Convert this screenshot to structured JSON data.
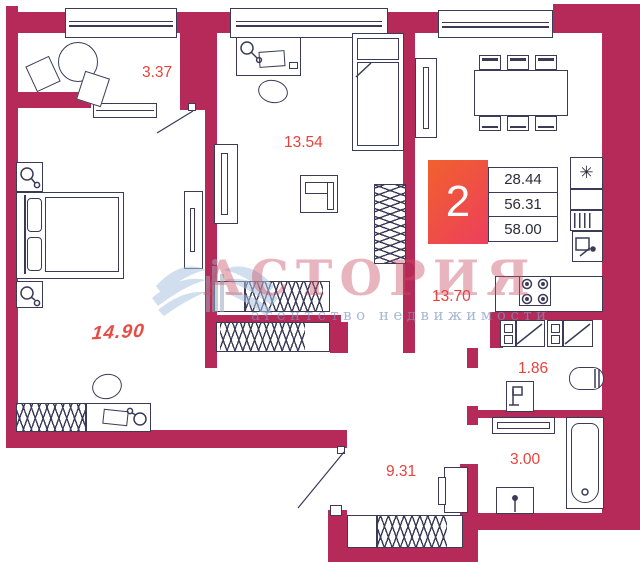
{
  "plan": {
    "badge": {
      "number": "2",
      "area_living": "28.44",
      "area_total": "56.31",
      "area_full": "58.00"
    },
    "rooms": {
      "balcony": "3.37",
      "living": "13.54",
      "kitchen": "13.70",
      "bedroom": "14.90",
      "wc": "1.86",
      "bathroom": "3.00",
      "hallway": "9.31"
    },
    "symbols": {
      "fridge": "✳"
    },
    "watermark": {
      "brand": "АСТОРИЯ",
      "subtitle": "агентство недвижимости"
    },
    "colors": {
      "wall": "#b52a58",
      "furniture_outline": "#3b3b58",
      "room_label": "#e8423d",
      "badge_gradient_start": "#f0612d",
      "badge_gradient_end": "#ee3f5d",
      "watermark_pink": "#c94f63",
      "watermark_blue": "#7d96be"
    }
  }
}
